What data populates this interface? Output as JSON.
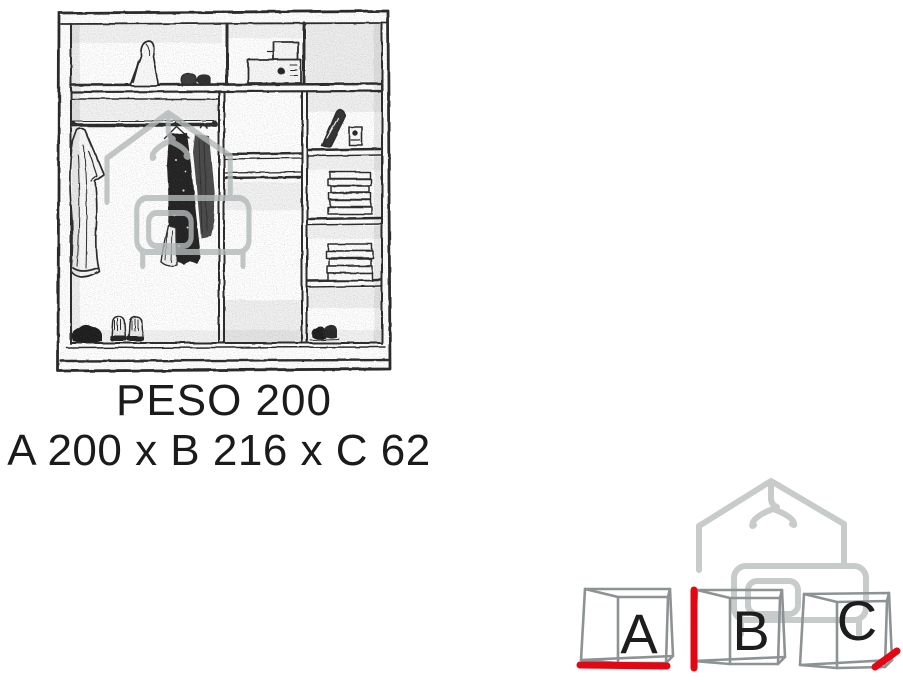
{
  "page": {
    "type": "product-dimension-diagram",
    "background": "#ffffff"
  },
  "product": {
    "model": "PESO 200",
    "dimensions_label": "A 200 x B 216 x C 62",
    "dimension_values": {
      "A": "200",
      "B": "216",
      "C": "62"
    }
  },
  "cubes": [
    {
      "label": "A",
      "highlighted_edge": "bottom-width"
    },
    {
      "label": "B",
      "highlighted_edge": "left-height"
    },
    {
      "label": "C",
      "highlighted_edge": "right-depth"
    }
  ],
  "icons": {
    "watermark": "house-hanger-bed-logo",
    "illustration": "wardrobe-interior-sketch"
  },
  "colors": {
    "accent_red": "#e30613",
    "cube_gray": "#8d9394",
    "watermark_gray": "#c7cbca",
    "watermark_gray_center": "#b3b8b8",
    "sketch_ink": "#262626",
    "text": "#1b1b1b"
  }
}
